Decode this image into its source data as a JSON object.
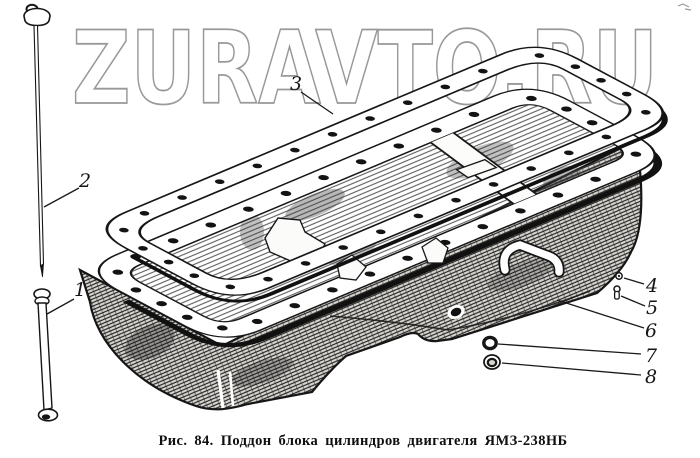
{
  "watermark": {
    "text": "ZURAVTO.RU",
    "color": "#8f8f8f"
  },
  "caption": "Рис. 84. Поддон блока цилиндров двигателя ЯМЗ-238НБ",
  "callouts": [
    "1",
    "2",
    "3",
    "4",
    "5",
    "6",
    "7",
    "8"
  ],
  "colors": {
    "ink": "#161616",
    "paper": "#ffffff",
    "watermark_gray": "#8f8f8f"
  }
}
